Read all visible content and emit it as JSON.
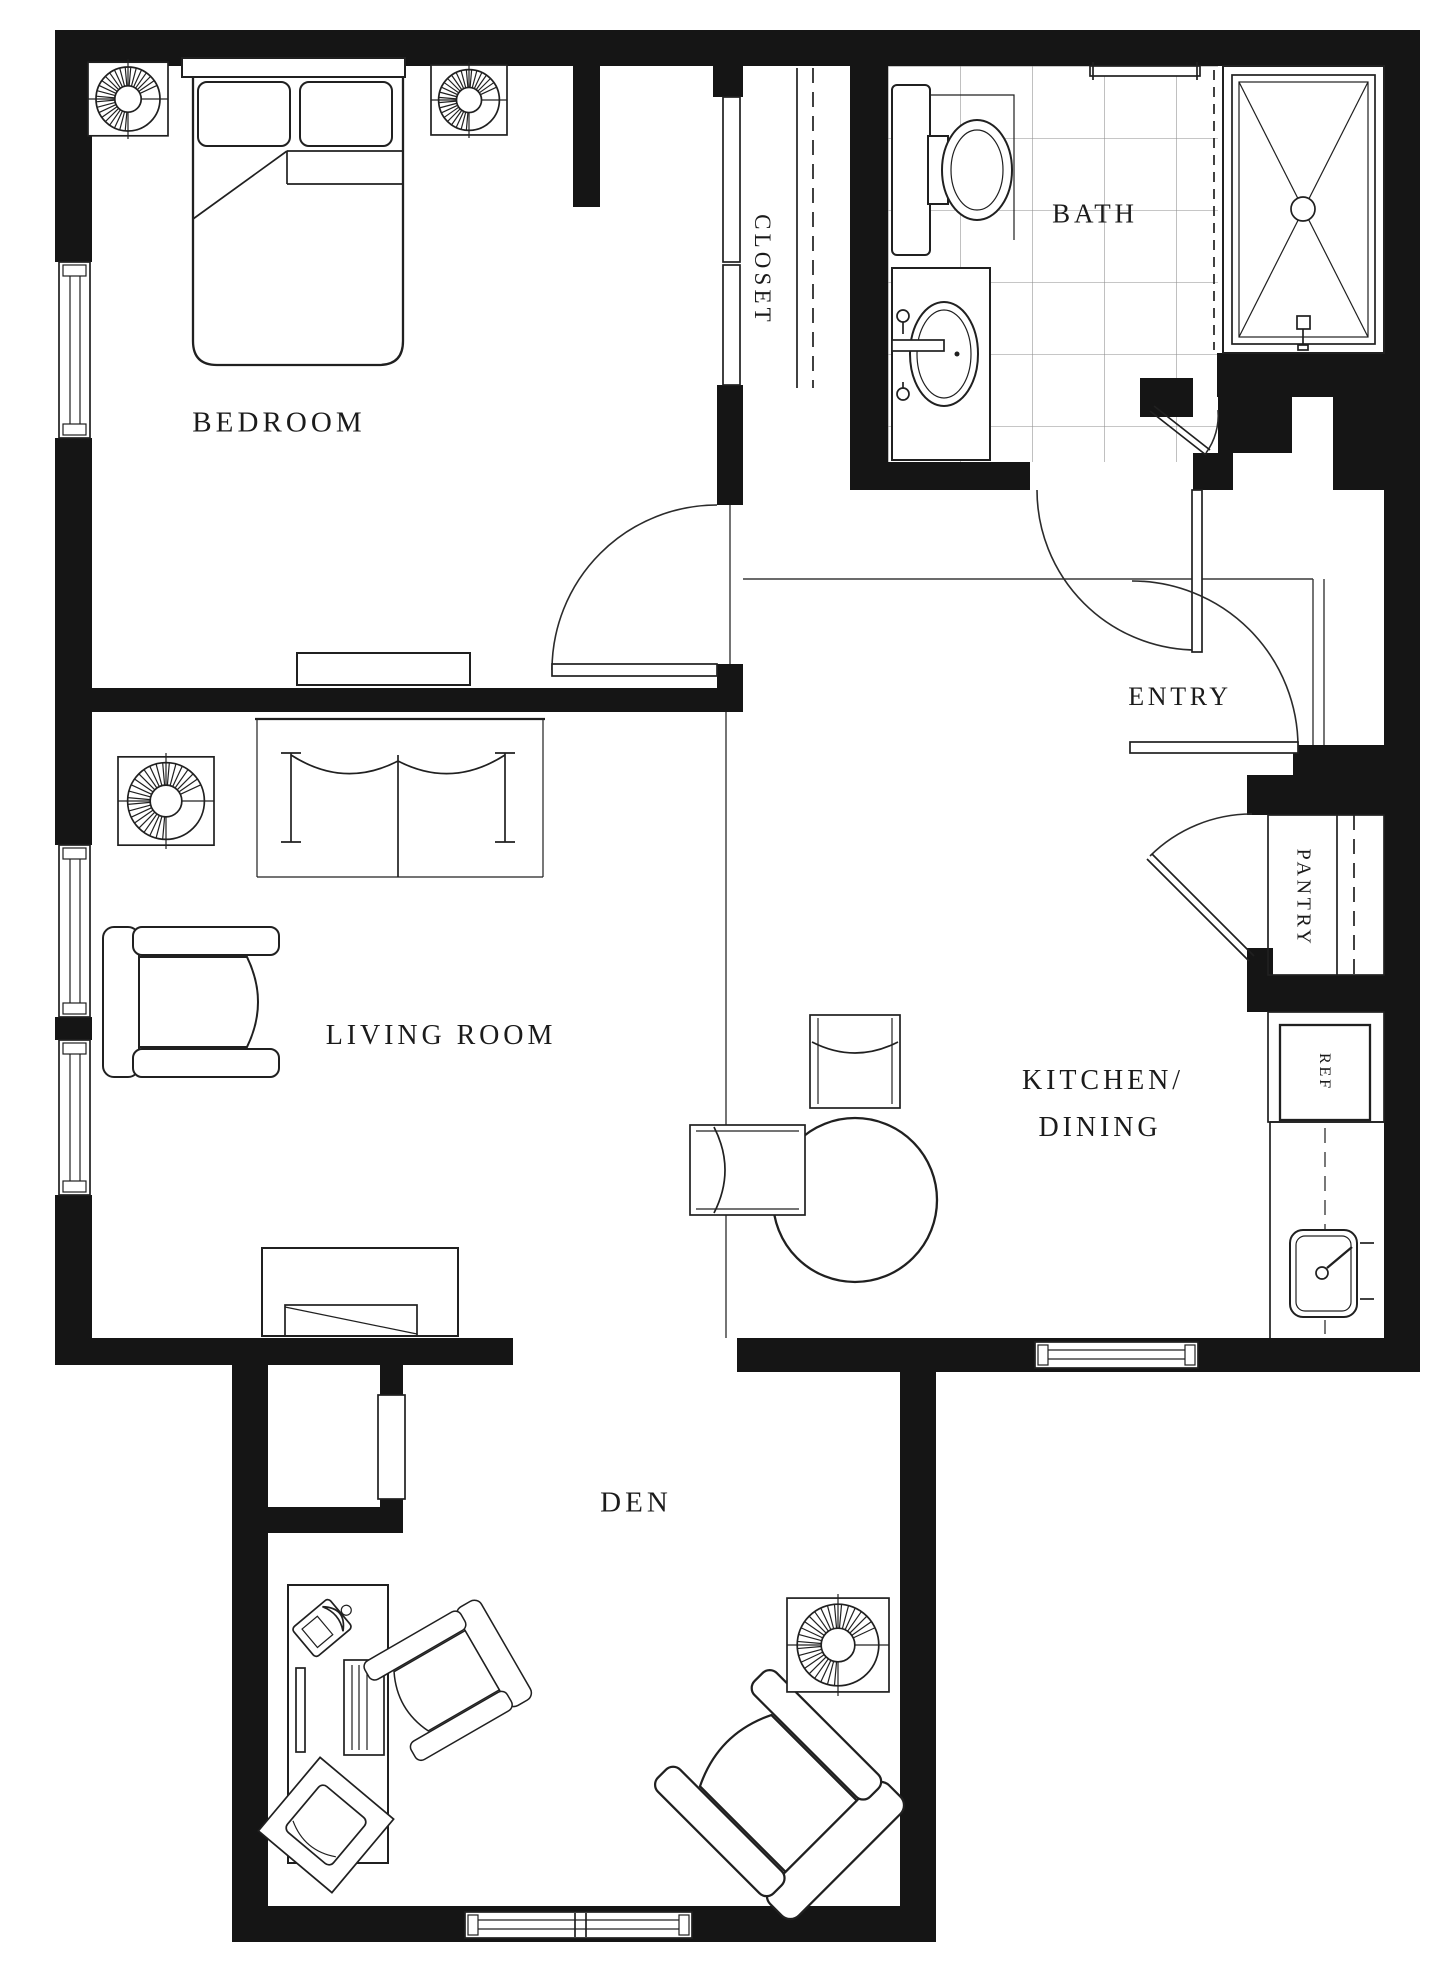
{
  "document": {
    "type": "architectural-floor-plan",
    "units": "none-shown"
  },
  "colors": {
    "wall": "#151515",
    "line": "#202020",
    "background": "#ffffff",
    "tile_grid": "#8d8d8d"
  },
  "rooms": {
    "bedroom": {
      "label": "BEDROOM"
    },
    "closet": {
      "label": "CLOSET"
    },
    "bath": {
      "label": "BATH"
    },
    "entry": {
      "label": "ENTRY"
    },
    "living_room": {
      "label": "LIVING ROOM"
    },
    "kitchen_dining": {
      "label_line1": "KITCHEN/",
      "label_line2": "DINING"
    },
    "pantry": {
      "label": "PANTRY"
    },
    "refrigerator": {
      "label": "REF"
    },
    "den": {
      "label": "DEN"
    }
  },
  "icons": {
    "ceiling_fan": "fan-icon",
    "bed": "double-bed-icon",
    "toilet": "toilet-icon",
    "bath_sink": "oval-sink-icon",
    "shower": "shower-x-icon",
    "kitchen_sink": "kitchen-sink-icon",
    "dining_table": "round-table-icon",
    "armchair": "armchair-icon",
    "desk_phone": "phone-icon",
    "door_swing": "door-arc-icon",
    "window": "window-icon"
  }
}
